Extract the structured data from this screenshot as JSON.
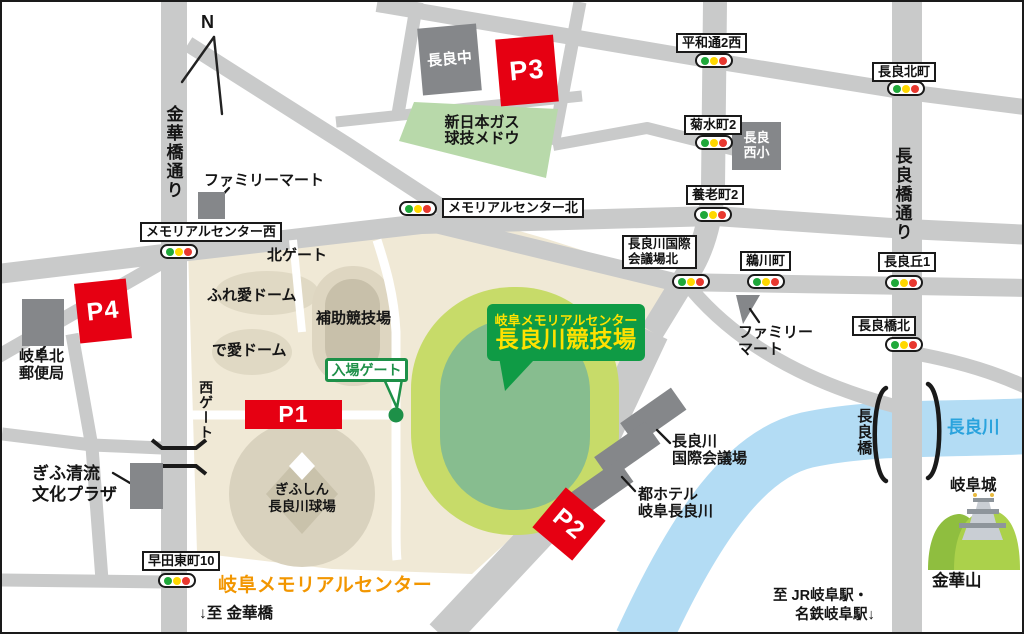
{
  "compass": {
    "label": "N"
  },
  "roads": {
    "kinkabashi": "金華橋通り",
    "nagarabashi": "長良橋通り"
  },
  "signals": {
    "memorial_west": "メモリアルセンター西",
    "memorial_north": "メモリアルセンター北",
    "heiwa2_west": "平和通2西",
    "nagara_kitamachi": "長良北町",
    "kikusui2": "菊水町2",
    "yoro2": "養老町2",
    "kaigijo_kita_line1": "長良川国際",
    "kaigijo_kita_line2": "会議場北",
    "ukawacho": "鵜川町",
    "nagaraoka1": "長良丘1",
    "nagarabashi_kita": "長良橋北",
    "sodahigashi10": "早田東町10"
  },
  "parking": {
    "p1": "P1",
    "p2": "P2",
    "p3": "P3",
    "p4": "P4"
  },
  "stadium": {
    "sign_line1": "岐阜メモリアルセンター",
    "sign_line2": "長良川競技場"
  },
  "gates": {
    "entrance": "入場ゲート",
    "north": "北ゲート",
    "west": "西ゲート"
  },
  "campus": {
    "name": "岐阜メモリアルセンター",
    "fureai_dome": "ふれ愛ドーム",
    "deai_dome": "で愛ドーム",
    "sub_stadium": "補助競技場",
    "baseball_line1": "ぎふしん",
    "baseball_line2": "長良川球場"
  },
  "places": {
    "familymart_nw": "ファミリーマート",
    "familymart_e_line1": "ファミリー",
    "familymart_e_line2": "マート",
    "nagara_jhs": "長良中",
    "gas_field_line1": "新日本ガス",
    "gas_field_line2": "球技メドウ",
    "nagara_es_line1": "長良",
    "nagara_es_line2": "西小",
    "post_line1": "岐阜北",
    "post_line2": "郵便局",
    "seiryu_line1": "ぎふ清流",
    "seiryu_line2": "文化プラザ",
    "kaigijo_line1": "長良川",
    "kaigijo_line2": "国際会議場",
    "hotel_line1": "都ホテル",
    "hotel_line2": "岐阜長良川",
    "castle": "岐阜城",
    "kinkazan": "金華山",
    "river": "長良川",
    "bridge": "長良橋"
  },
  "directions": {
    "to_kinkabashi": "↓至 金華橋",
    "to_stations_line1": "至 JR岐阜駅・",
    "to_stations_line2": "名鉄岐阜駅↓"
  },
  "colors": {
    "parking_red": "#e60012",
    "sign_green": "#0f9b45",
    "sign_yellow": "#ffe100",
    "entrance_green": "#1d9048",
    "campus_orange": "#f29600",
    "campus_beige": "#f0e9d6",
    "road_gray": "#c9caca",
    "building_gray": "#85878a",
    "river_blue": "#b3dcf4",
    "river_text_blue": "#2aa3dd",
    "stadium_outer_green": "#c7db69",
    "stadium_inner_green": "#87bd8f",
    "signal_green": "#1fa83a",
    "signal_yellow": "#ffd800",
    "signal_red": "#e8382f"
  }
}
